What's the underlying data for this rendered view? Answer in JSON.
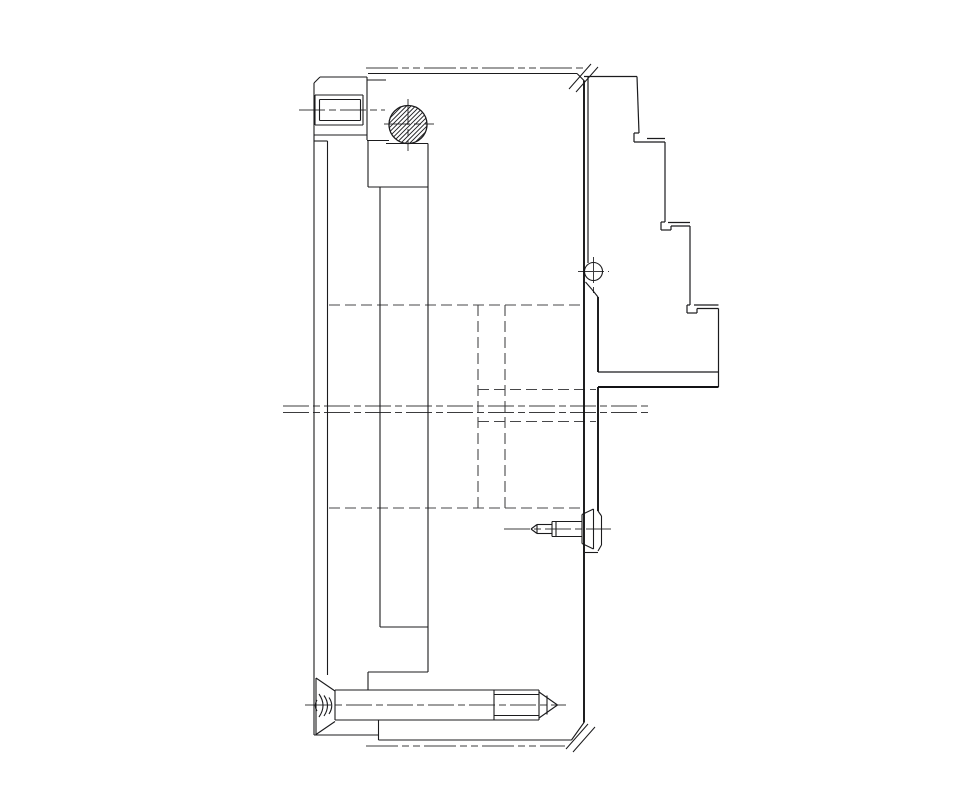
{
  "canvas": {
    "width": 976,
    "height": 800,
    "viewBox": "0 0 976 800",
    "background": "#ffffff",
    "stroke_solid": "#1b1b1d",
    "stroke_dashed": "#474749"
  },
  "drawing": {
    "description": "section-side-view-of-lathe-chuck-with-stepped-jaw-and-mounting-screws",
    "groups": [
      {
        "name": "phantom-chain-lines",
        "stroke": "#3c3c3e",
        "width": 1.1,
        "dash": "32 4 7 4 7 4",
        "lines": [
          [
            366,
            68,
            586,
            68
          ],
          [
            366,
            746,
            565,
            746
          ]
        ]
      },
      {
        "name": "hidden-lines",
        "stroke": "#474749",
        "width": 1.1,
        "dash": "11 5",
        "lines": [
          [
            329,
            305,
            584,
            305
          ],
          [
            329,
            508,
            584,
            508
          ],
          [
            478,
            305,
            478,
            508
          ],
          [
            505,
            305,
            505,
            508
          ],
          [
            478,
            389.5,
            596,
            389.5
          ],
          [
            478,
            421.5,
            596,
            421.5
          ]
        ]
      },
      {
        "name": "center-lines",
        "stroke": "#3c3c3e",
        "width": 1.0,
        "dash": "26 4 7 4",
        "lines": [
          [
            299,
            110,
            385,
            110
          ],
          [
            384,
            124,
            434,
            124
          ],
          [
            408,
            99,
            408,
            151
          ],
          [
            593.5,
            257,
            593.5,
            293
          ],
          [
            578,
            271.5,
            609,
            271.5
          ],
          [
            283,
            406,
            652,
            406
          ],
          [
            283,
            412.5,
            652,
            412.5
          ],
          [
            504,
            529,
            611,
            529
          ],
          [
            305,
            705,
            566,
            705
          ]
        ]
      },
      {
        "name": "body-outline-solid",
        "stroke": "#1b1b1d",
        "width": 1.1,
        "dash": null,
        "lines": [
          [
            314,
            83,
            320,
            77
          ],
          [
            320,
            77,
            367,
            77
          ],
          [
            367,
            77,
            367,
            140
          ],
          [
            314,
            135,
            367,
            135
          ],
          [
            314,
            83,
            314,
            135
          ],
          [
            314,
            141,
            327.5,
            141
          ],
          [
            314,
            135,
            314,
            735
          ],
          [
            315,
            95,
            363,
            95
          ],
          [
            363,
            95,
            363,
            125
          ],
          [
            315,
            125,
            363,
            125
          ],
          [
            315,
            95,
            315,
            125
          ],
          [
            319.5,
            99.5,
            360.5,
            99.5
          ],
          [
            360.5,
            99.5,
            360.5,
            120.5
          ],
          [
            319.5,
            120.5,
            360.5,
            120.5
          ],
          [
            319.5,
            99.5,
            319.5,
            120.5
          ],
          [
            327.5,
            141,
            327.5,
            675
          ],
          [
            368,
            73.5,
            577,
            73.5
          ],
          [
            577,
            73.5,
            584,
            80.5
          ],
          [
            367,
            80,
            386,
            80
          ],
          [
            367,
            140.5,
            389,
            140.5
          ],
          [
            386,
            143.5,
            428,
            143.5
          ],
          [
            368,
            140.5,
            368,
            187
          ],
          [
            368,
            187,
            428,
            187
          ],
          [
            380,
            187,
            380,
            627
          ],
          [
            428,
            143.5,
            428,
            672
          ],
          [
            380,
            627,
            428,
            627
          ],
          [
            368,
            672,
            428,
            672
          ],
          [
            368,
            672,
            368,
            689.5
          ],
          [
            571.5,
            740,
            584,
            722.5
          ],
          [
            378.5,
            740,
            571.5,
            740
          ],
          [
            378.5,
            720,
            378.5,
            740
          ],
          [
            314,
            735,
            378.5,
            735
          ]
        ]
      },
      {
        "name": "jaw-step-profile",
        "stroke": "#1b1b1d",
        "width": 1.2,
        "dash": null,
        "lines": [
          [
            584,
            76.5,
            637,
            76.5
          ],
          [
            588,
            76.5,
            588,
            263
          ],
          [
            637,
            76.5,
            639,
            133
          ],
          [
            634,
            133,
            639,
            133
          ],
          [
            634,
            133,
            634,
            142
          ],
          [
            634,
            142,
            665,
            142
          ],
          [
            647,
            138.5,
            665,
            138.5
          ],
          [
            665,
            142,
            665,
            222
          ],
          [
            661,
            222,
            665,
            222
          ],
          [
            661,
            222,
            661,
            230
          ],
          [
            661,
            230,
            671,
            230
          ],
          [
            671,
            230,
            671,
            226
          ],
          [
            671,
            226,
            690,
            226
          ],
          [
            668,
            222.5,
            690,
            222.5
          ],
          [
            690,
            226,
            690,
            305
          ],
          [
            687,
            305,
            690,
            305
          ],
          [
            687,
            305,
            687,
            313
          ],
          [
            687,
            313,
            697,
            313
          ],
          [
            697,
            313,
            697,
            308.5
          ],
          [
            697,
            308.5,
            718.5,
            308.5
          ],
          [
            694,
            305,
            718.5,
            305
          ],
          [
            718.5,
            308.5,
            718.5,
            387
          ],
          [
            598,
            372,
            718.5,
            372
          ]
        ]
      },
      {
        "name": "guard-plate-and-knob",
        "stroke": "#1b1b1d",
        "width": 1.1,
        "dash": null,
        "lines": [
          [
            585.5,
            282,
            592,
            289.5
          ],
          [
            592,
            289.5,
            598,
            297
          ],
          [
            585,
            552.5,
            598,
            552.5
          ],
          [
            598,
            511,
            601.5,
            516
          ],
          [
            601.5,
            516,
            601.5,
            545
          ],
          [
            601.5,
            545,
            598,
            551
          ]
        ],
        "circles": [
          [
            593.5,
            271.5,
            9
          ]
        ]
      },
      {
        "name": "side-lock-screw",
        "stroke": "#1b1b1d",
        "width": 1.1,
        "dash": null,
        "lines": [
          [
            537,
            524.5,
            531,
            529
          ],
          [
            531,
            529,
            537,
            533.5
          ],
          [
            537,
            524.5,
            537,
            533.5
          ],
          [
            537,
            524.5,
            552,
            524.5
          ],
          [
            537,
            533.5,
            552,
            533.5
          ],
          [
            552,
            521.5,
            552,
            536.5
          ],
          [
            556,
            521.5,
            556,
            536.5
          ],
          [
            552,
            521.5,
            582,
            521.5
          ],
          [
            552,
            536.5,
            582,
            536.5
          ],
          [
            582,
            514.5,
            582,
            543.5
          ],
          [
            582,
            514.5,
            593.5,
            509
          ],
          [
            582,
            543.5,
            593.5,
            549
          ],
          [
            593.5,
            509,
            593.5,
            549
          ]
        ]
      },
      {
        "name": "bottom-countersunk-bolt",
        "stroke": "#1b1b1d",
        "width": 1.1,
        "dash": null,
        "lines": [
          [
            316,
            678,
            316,
            734.5
          ],
          [
            316,
            678,
            335,
            691
          ],
          [
            316,
            734.5,
            335,
            721.5
          ],
          [
            335,
            690,
            335,
            720
          ],
          [
            335,
            690,
            539,
            690
          ],
          [
            335,
            720,
            539,
            720
          ],
          [
            494,
            690,
            494,
            720
          ],
          [
            494,
            694.5,
            539,
            694.5
          ],
          [
            494,
            715.5,
            539,
            715.5
          ],
          [
            539,
            690,
            539,
            720
          ],
          [
            539,
            692,
            557.5,
            705
          ],
          [
            539,
            718,
            557.5,
            705
          ],
          [
            547,
            695.5,
            547,
            714.5
          ]
        ],
        "paths": [
          "M319,694 Q327,705.5 319,717",
          "M324,695.5 Q331,705.5 324,716",
          "M329,697.5 Q334.5,705.5 329,714",
          "M317,700 Q313.5,705.5 317,711"
        ]
      },
      {
        "name": "heavy-edges",
        "stroke": "#131315",
        "width": 1.9,
        "dash": null,
        "lines": [
          [
            584,
            80.5,
            584,
            722.5
          ],
          [
            598,
            297,
            598,
            372
          ],
          [
            598,
            387,
            598,
            511
          ],
          [
            598,
            387,
            718.5,
            387
          ]
        ]
      },
      {
        "name": "break-marks",
        "stroke": "#1b1b1d",
        "width": 1.0,
        "dash": null,
        "lines": [
          [
            569,
            89,
            591,
            64
          ],
          [
            576,
            92,
            598,
            67
          ],
          [
            566,
            749,
            588,
            724
          ],
          [
            573,
            752,
            595,
            727
          ]
        ]
      }
    ],
    "hatched_circle": {
      "cx": 408,
      "cy": 124.5,
      "r": 19,
      "spacing": 4.5,
      "angle_deg": 45,
      "stroke": "#1b1b1d",
      "line_width": 0.9,
      "outline_width": 1.3
    }
  }
}
